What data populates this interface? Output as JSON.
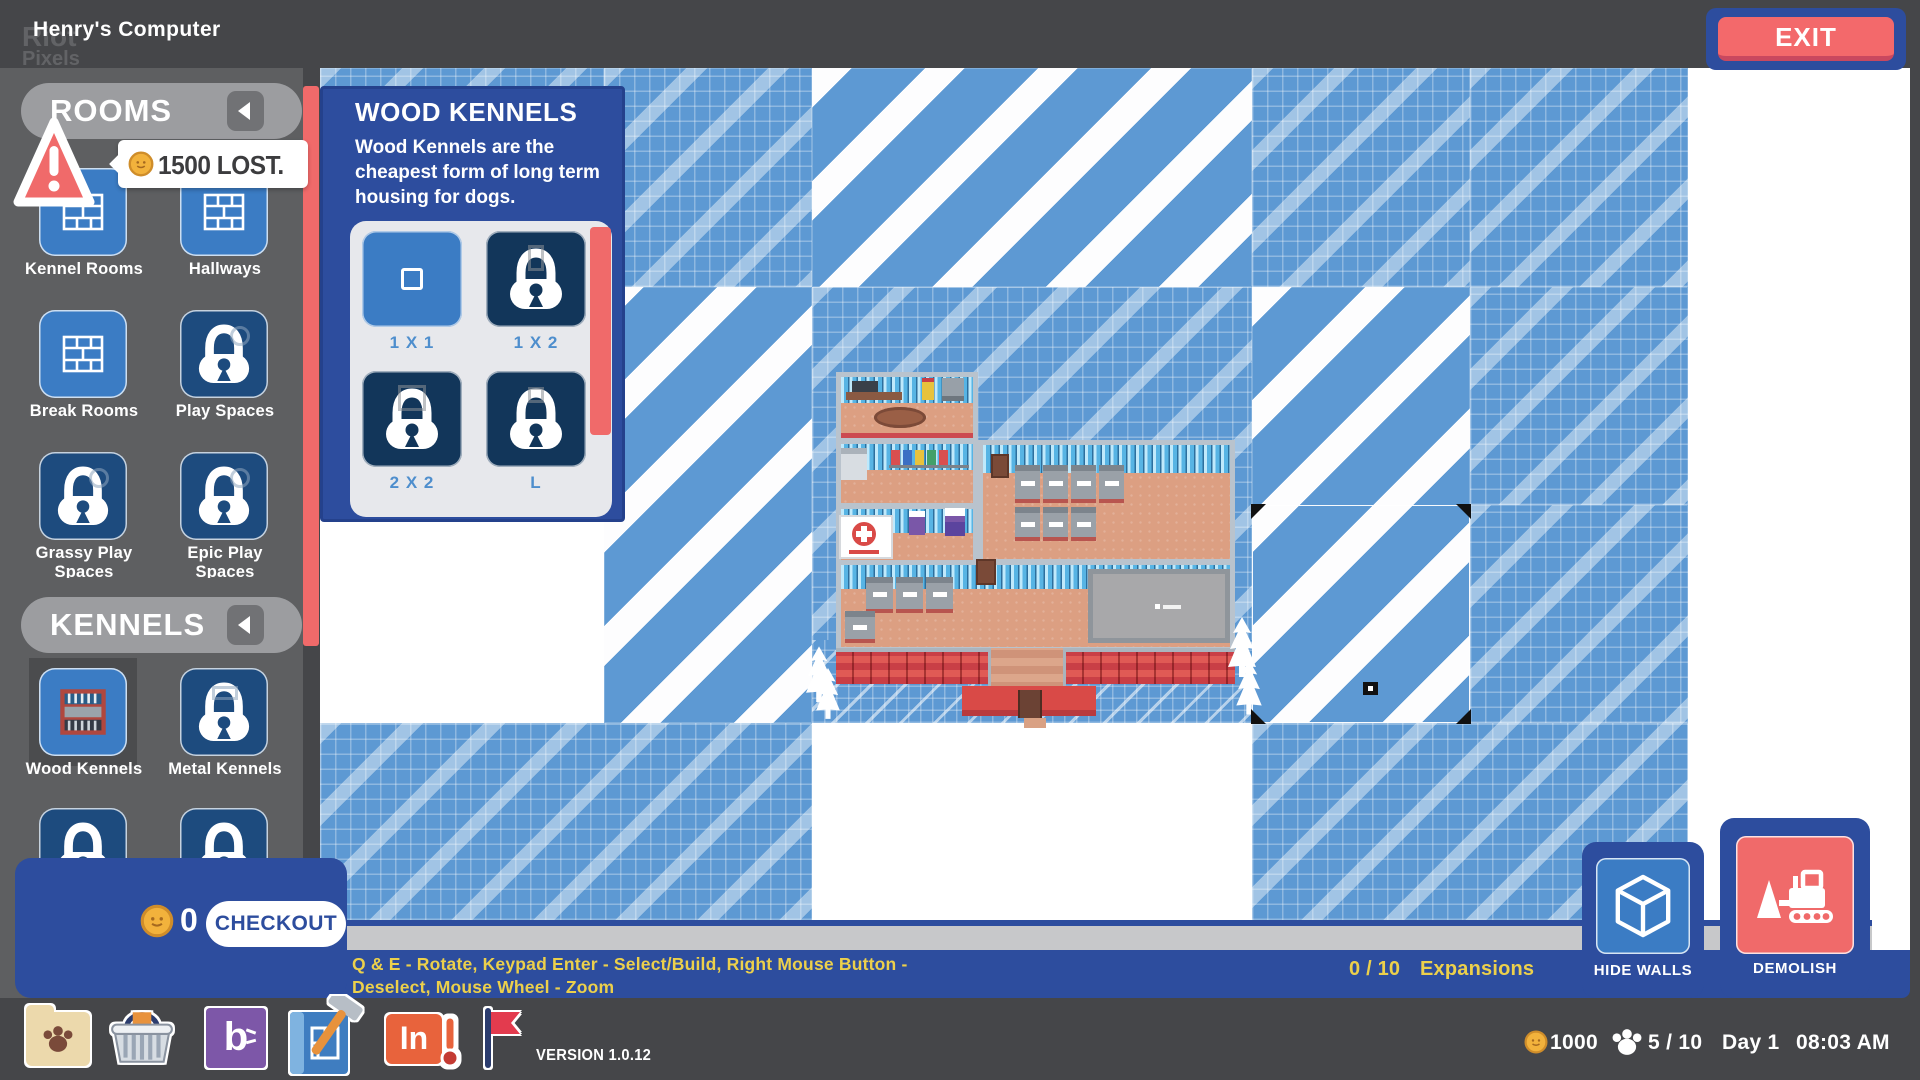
{
  "header": {
    "title": "Henry's Computer",
    "watermark_line1": "Riot",
    "watermark_line2": "Pixels",
    "exit_label": "EXIT"
  },
  "alert": {
    "message": "1500 LOST."
  },
  "sidebar": {
    "rooms_header": "ROOMS",
    "kennels_header": "KENNELS",
    "rooms_items": [
      {
        "label": "Kennel Rooms",
        "locked": false
      },
      {
        "label": "Hallways",
        "locked": false
      },
      {
        "label": "Break Rooms",
        "locked": false
      },
      {
        "label": "Play Spaces",
        "locked": true
      },
      {
        "label": "Grassy Play Spaces",
        "locked": true
      },
      {
        "label": "Epic Play Spaces",
        "locked": true
      }
    ],
    "kennels_items": [
      {
        "label": "Wood Kennels",
        "locked": false,
        "selected": true
      },
      {
        "label": "Metal Kennels",
        "locked": true
      }
    ],
    "cart": {
      "coins": "0",
      "checkout_label": "CHECKOUT"
    }
  },
  "popup": {
    "title": "WOOD KENNELS",
    "description": "Wood Kennels are the cheapest form of long term housing for dogs.",
    "options": [
      {
        "label": "1 X 1",
        "locked": false
      },
      {
        "label": "1 X 2",
        "locked": true
      },
      {
        "label": "2 X 2",
        "locked": true
      },
      {
        "label": "L",
        "locked": true
      }
    ]
  },
  "bottom_bar": {
    "instructions_line1": "Q & E  - Rotate,  Keypad Enter  - Select/Build,  Right Mouse Button  -",
    "instructions_line2": "Deselect, Mouse Wheel - Zoom",
    "expansions_count": "0 / 10",
    "expansions_label": "Expansions",
    "hide_walls_label": "HIDE WALLS",
    "demolish_label": "DEMOLISH"
  },
  "taskbar": {
    "b_logo_text": "b",
    "in_logo_text": "In",
    "version": "VERSION 1.0.12",
    "status": {
      "coins": "1000",
      "capacity": "5 / 10",
      "day": "Day 1",
      "time": "08:03 AM"
    }
  },
  "colors": {
    "accent_blue": "#2d4d9e",
    "tile_blue": "#3b7cc4",
    "locked_navy": "#1d4b7e",
    "map_blue": "#5d99d3",
    "alert_red": "#f06a6a",
    "coin_gold": "#f2b23c",
    "instruction_yellow": "#ecd04b"
  }
}
